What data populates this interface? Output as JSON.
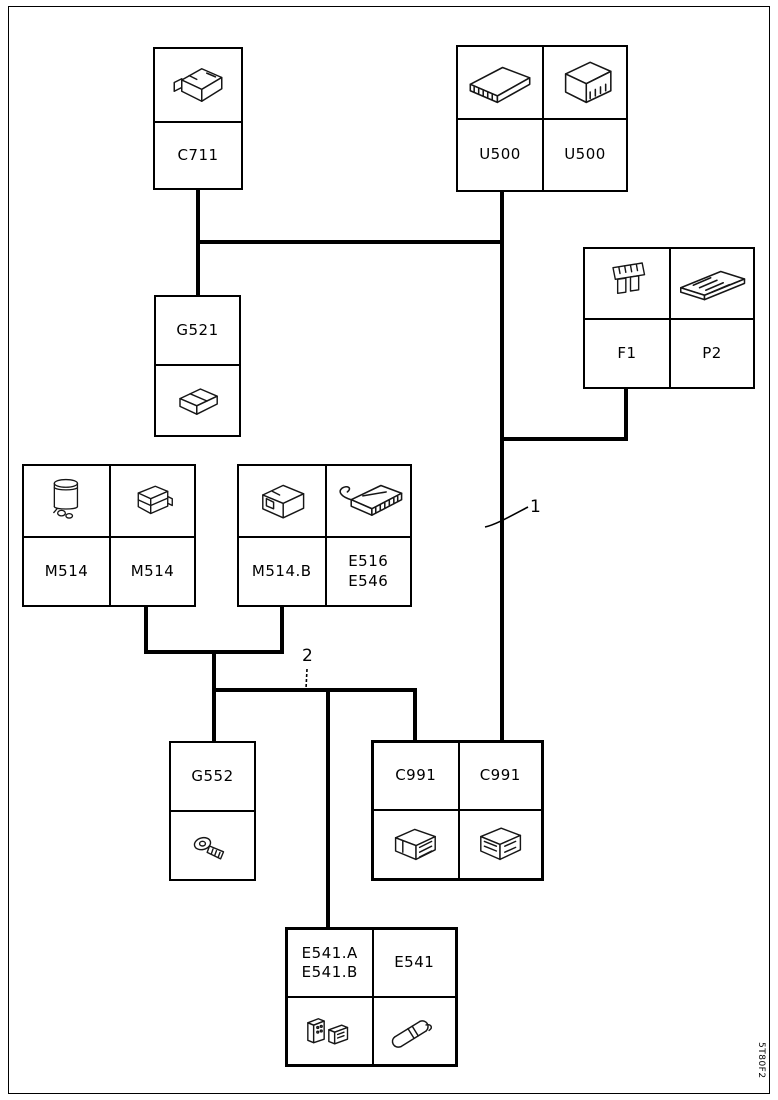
{
  "doc_code": "5T80F2",
  "colors": {
    "line": "#000000",
    "background": "#ffffff"
  },
  "callouts": [
    {
      "label": "1"
    },
    {
      "label": "2"
    }
  ],
  "components": {
    "c711": {
      "label": "C711",
      "icon": "control-module-icon"
    },
    "u500_flat": {
      "label": "U500",
      "icon": "flat-module-icon"
    },
    "u500_box": {
      "label": "U500",
      "icon": "box-module-icon"
    },
    "g521": {
      "label": "G521",
      "icon": "connector-block-icon"
    },
    "f1": {
      "label": "F1",
      "icon": "blade-fuse-icon"
    },
    "p2": {
      "label": "P2",
      "icon": "circuit-board-icon"
    },
    "m514_pump": {
      "label": "M514",
      "icon": "pump-reservoir-icon"
    },
    "m514_bracket": {
      "label": "M514",
      "icon": "mounting-bracket-icon"
    },
    "m514b": {
      "label": "M514.B",
      "icon": "connector-housing-icon"
    },
    "e516_e546": {
      "lines": [
        "E516",
        "E546"
      ],
      "icon": "ecu-module-icon"
    },
    "g552": {
      "label": "G552",
      "icon": "ring-terminal-icon"
    },
    "c991_left": {
      "label": "C991",
      "icon": "connector-male-icon"
    },
    "c991_right": {
      "label": "C991",
      "icon": "connector-female-icon"
    },
    "e541_ab": {
      "lines": [
        "E541.A",
        "E541.B"
      ],
      "icon": "connector-pair-icon"
    },
    "e541": {
      "label": "E541",
      "icon": "cylindrical-sensor-icon"
    }
  },
  "connections": [
    [
      "C711",
      "harness-trunk"
    ],
    [
      "U500",
      "harness-trunk"
    ],
    [
      "harness-trunk",
      "G521"
    ],
    [
      "F1/P2",
      "harness-trunk"
    ],
    [
      "harness-trunk",
      "C991"
    ],
    [
      "M514",
      "harness-branch"
    ],
    [
      "M514.B",
      "harness-branch"
    ],
    [
      "harness-branch",
      "G552"
    ],
    [
      "harness-branch",
      "E541.A/E541.B"
    ],
    [
      "harness-branch",
      "C991"
    ]
  ]
}
